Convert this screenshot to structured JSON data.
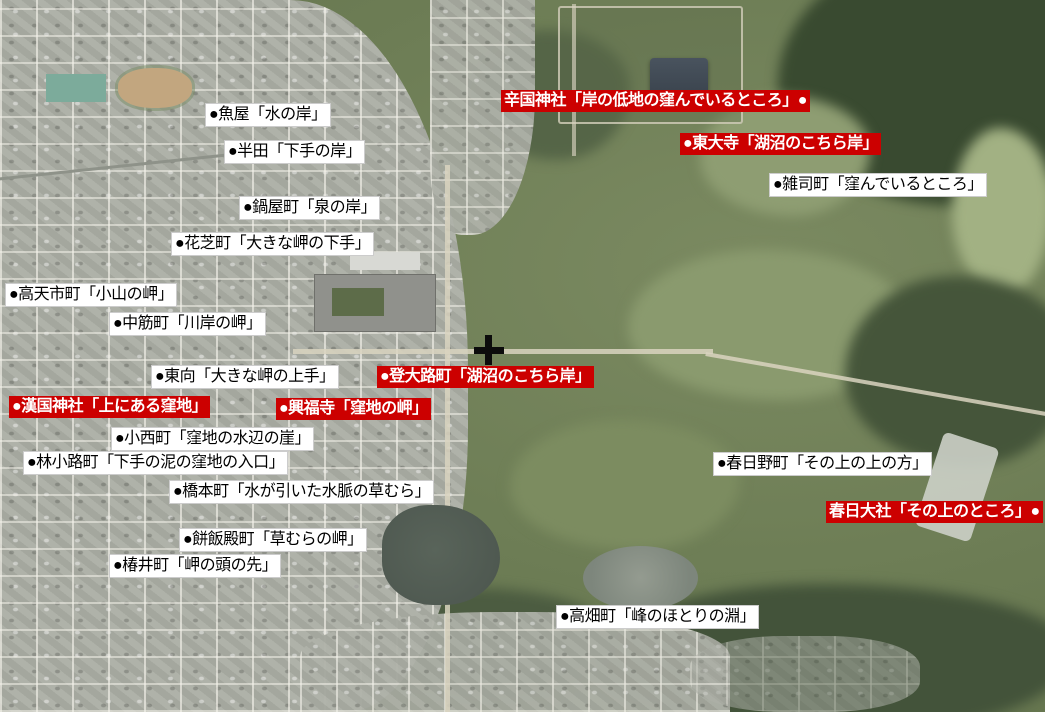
{
  "map": {
    "kind": "satellite-aerial-photo",
    "marker": {
      "symbol": "+",
      "color": "#0c0c0c",
      "x": 489,
      "y": 350
    },
    "colors": {
      "label_red_bg": "#cc0000",
      "label_red_text": "#ffffff",
      "label_white_bg": "#ffffff",
      "label_white_text": "#000000",
      "marker": "#0c0c0c"
    },
    "labels": [
      {
        "id": "uoya",
        "variant": "white",
        "x": 205,
        "y": 103,
        "text": "●魚屋「水の岸」"
      },
      {
        "id": "handa",
        "variant": "white",
        "x": 224,
        "y": 140,
        "text": "●半田「下手の岸」"
      },
      {
        "id": "nabeyacho",
        "variant": "white",
        "x": 239,
        "y": 196,
        "text": "●鍋屋町「泉の岸」"
      },
      {
        "id": "hanashibacho",
        "variant": "white",
        "x": 171,
        "y": 232,
        "text": "●花芝町「大きな岬の下手」"
      },
      {
        "id": "takamaichicho",
        "variant": "white",
        "x": 5,
        "y": 283,
        "text": "●高天市町「小山の岬」"
      },
      {
        "id": "nakasujicho",
        "variant": "white",
        "x": 109,
        "y": 312,
        "text": "●中筋町「川岸の岬」"
      },
      {
        "id": "higashimuki",
        "variant": "white",
        "x": 151,
        "y": 365,
        "text": "●東向「大きな岬の上手」"
      },
      {
        "id": "kangoku-jinja",
        "variant": "red",
        "x": 9,
        "y": 396,
        "text": "●漢国神社「上にある窪地」"
      },
      {
        "id": "konishicho",
        "variant": "white",
        "x": 111,
        "y": 427,
        "text": "●小西町「窪地の水辺の崖」"
      },
      {
        "id": "hayashikojicho",
        "variant": "white",
        "x": 23,
        "y": 451,
        "text": "●林小路町「下手の泥の窪地の入口」"
      },
      {
        "id": "hashimotocho",
        "variant": "white",
        "x": 169,
        "y": 480,
        "text": "●橋本町「水が引いた水脈の草むら」"
      },
      {
        "id": "mochiidonocho",
        "variant": "white",
        "x": 179,
        "y": 528,
        "text": "●餅飯殿町「草むらの岬」"
      },
      {
        "id": "tsubaicho",
        "variant": "white",
        "x": 109,
        "y": 554,
        "text": "●椿井町「岬の頭の先」"
      },
      {
        "id": "karakuni-jinja",
        "variant": "red",
        "x": 501,
        "y": 90,
        "text": "辛国神社「岸の低地の窪んでいるところ」●"
      },
      {
        "id": "todaiji",
        "variant": "red",
        "x": 680,
        "y": 133,
        "text": "●東大寺「湖沼のこちら岸」"
      },
      {
        "id": "zoshicho",
        "variant": "white",
        "x": 769,
        "y": 173,
        "text": "●雑司町「窪んでいるところ」"
      },
      {
        "id": "noboriojicho",
        "variant": "red",
        "x": 377,
        "y": 366,
        "text": "●登大路町「湖沼のこちら岸」"
      },
      {
        "id": "kofukuji",
        "variant": "red",
        "x": 276,
        "y": 398,
        "text": "●興福寺「窪地の岬」"
      },
      {
        "id": "kasuganocho",
        "variant": "white",
        "x": 713,
        "y": 452,
        "text": "●春日野町「その上の上の方」"
      },
      {
        "id": "kasuga-taisha",
        "variant": "red",
        "x": 826,
        "y": 501,
        "text": "春日大社「その上のところ」●"
      },
      {
        "id": "takabatakecho",
        "variant": "white",
        "x": 556,
        "y": 605,
        "text": "●高畑町「峰のほとりの淵」"
      }
    ]
  }
}
